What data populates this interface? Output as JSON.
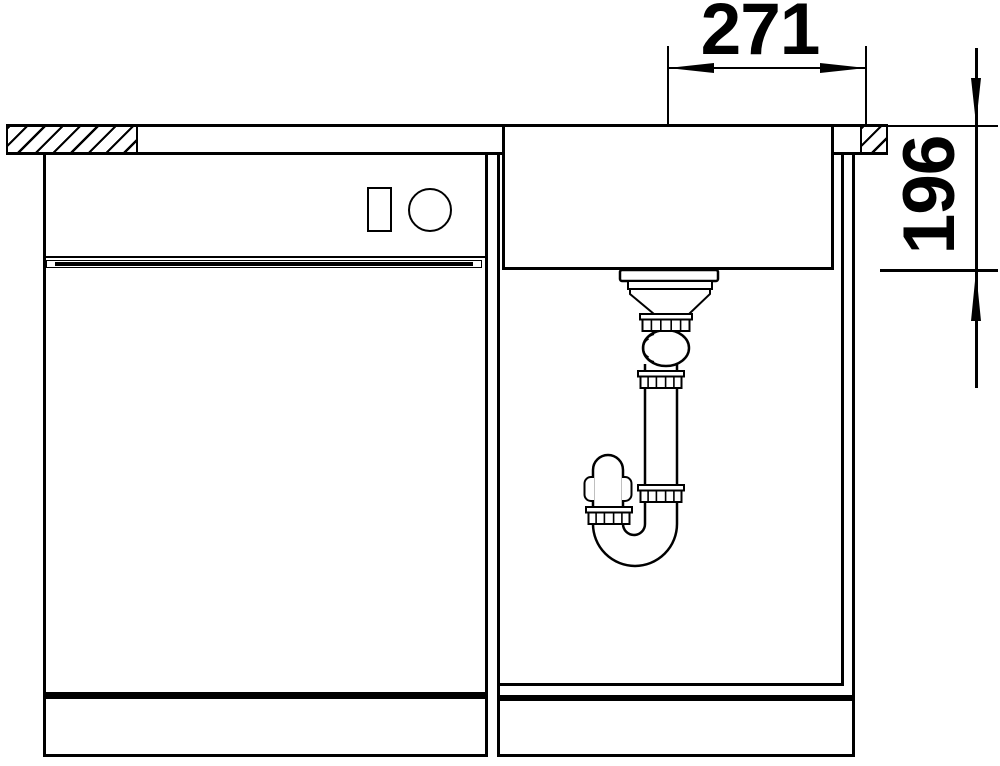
{
  "drawing": {
    "type": "sink-base-cabinet-installation-section",
    "dimensions": {
      "horizontal": {
        "value": "271",
        "meaning": "drain-center-to-right-edge"
      },
      "vertical": {
        "value": "196",
        "meaning": "bowl-depth-from-worktop"
      }
    },
    "colors": {
      "line": "#000000",
      "background": "#ffffff"
    }
  }
}
